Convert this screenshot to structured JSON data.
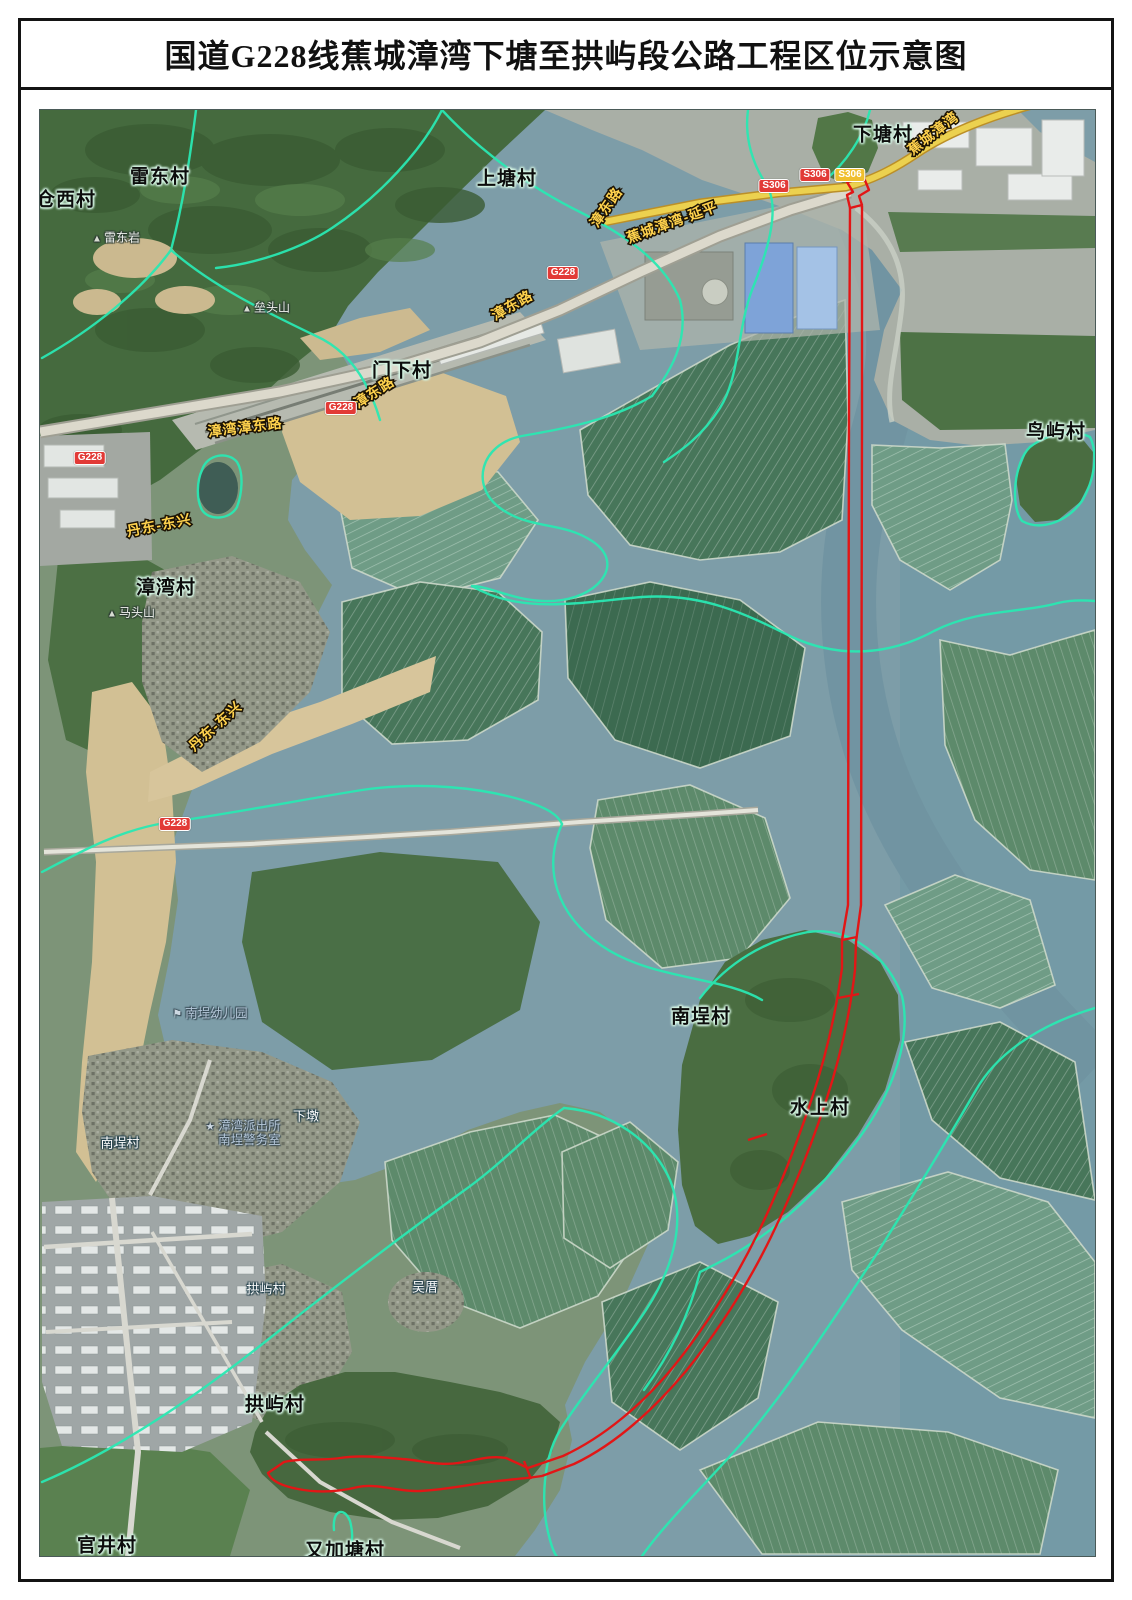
{
  "page": {
    "title": "国道G228线蕉城漳湾下塘至拱屿段公路工程区位示意图"
  },
  "colors": {
    "route": "#e21616",
    "boundary": "#2ae8b2",
    "road_label": "#ffd24d",
    "badge_red": "#e23a36",
    "badge_yellow": "#f0bf2e",
    "water": "#7d9da8"
  },
  "map": {
    "villages_major": [
      {
        "text": "仓西村",
        "x": 66,
        "y": 198
      },
      {
        "text": "雷东村",
        "x": 160,
        "y": 175
      },
      {
        "text": "上塘村",
        "x": 507,
        "y": 177
      },
      {
        "text": "下塘村",
        "x": 883,
        "y": 133
      },
      {
        "text": "门下村",
        "x": 402,
        "y": 369
      },
      {
        "text": "漳湾村",
        "x": 166,
        "y": 586
      },
      {
        "text": "鸟屿村",
        "x": 1056,
        "y": 430
      },
      {
        "text": "南埕村",
        "x": 701,
        "y": 1015
      },
      {
        "text": "水上村",
        "x": 820,
        "y": 1106
      },
      {
        "text": "拱屿村",
        "x": 275,
        "y": 1403
      },
      {
        "text": "官井村",
        "x": 107,
        "y": 1544
      },
      {
        "text": "又加塘村",
        "x": 345,
        "y": 1549
      }
    ],
    "villages_minor": [
      {
        "text": "南埕村",
        "x": 120,
        "y": 1142
      },
      {
        "text": "下墩",
        "x": 306,
        "y": 1115
      },
      {
        "text": "拱屿村",
        "x": 266,
        "y": 1288
      },
      {
        "text": "吴厝",
        "x": 425,
        "y": 1286
      }
    ],
    "mountains": [
      {
        "text": "雷东岩",
        "x": 116,
        "y": 237
      },
      {
        "text": "垒头山",
        "x": 266,
        "y": 307
      },
      {
        "text": "马头山",
        "x": 131,
        "y": 612
      }
    ],
    "pois": [
      {
        "icon": "police-star",
        "lines": [
          "漳湾派出所",
          "南埕警务室"
        ],
        "x": 243,
        "y": 1133
      },
      {
        "icon": "school-flag",
        "lines": [
          "南埕幼儿园"
        ],
        "x": 210,
        "y": 1014
      }
    ],
    "road_labels": [
      {
        "text": "蕉城漳湾",
        "x": 933,
        "y": 133,
        "rot": -38
      },
      {
        "text": "漳东路",
        "x": 606,
        "y": 207,
        "rot": -55
      },
      {
        "text": "蕉城漳湾-延平",
        "x": 672,
        "y": 222,
        "rot": -20
      },
      {
        "text": "漳东路",
        "x": 512,
        "y": 305,
        "rot": -30
      },
      {
        "text": "漳东路",
        "x": 374,
        "y": 392,
        "rot": -33
      },
      {
        "text": "漳湾漳东路",
        "x": 245,
        "y": 427,
        "rot": -7
      },
      {
        "text": "丹东-东兴",
        "x": 159,
        "y": 525,
        "rot": -11
      },
      {
        "text": "丹东-东兴",
        "x": 215,
        "y": 726,
        "rot": -42
      }
    ],
    "badges": [
      {
        "text": "G228",
        "type": "red",
        "x": 563,
        "y": 273
      },
      {
        "text": "G228",
        "type": "red",
        "x": 341,
        "y": 408
      },
      {
        "text": "G228",
        "type": "red",
        "x": 90,
        "y": 458
      },
      {
        "text": "G228",
        "type": "red",
        "x": 175,
        "y": 824
      },
      {
        "text": "S306",
        "type": "red",
        "x": 774,
        "y": 186
      },
      {
        "text": "S306",
        "type": "red",
        "x": 815,
        "y": 175
      },
      {
        "text": "S306",
        "type": "yellow",
        "x": 850,
        "y": 175
      }
    ]
  }
}
